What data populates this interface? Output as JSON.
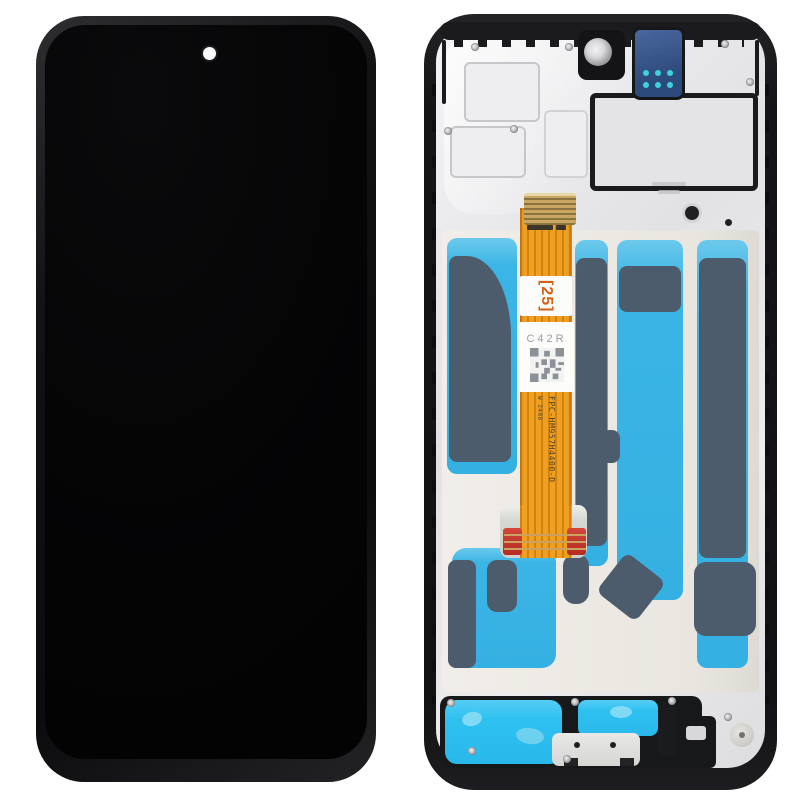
{
  "markings": {
    "flex_box_label": "[25]",
    "flex_label_code": "C42R",
    "flex_part_number": "FPC-HM957H4400-D",
    "flex_batch_code": "W 2408"
  },
  "colors": {
    "background": "#ffffff",
    "screen_black": "#050506",
    "frame_black": "#1b1b1d",
    "plate_silver": "#e8e8ea",
    "liner_beige": "#eeebe5",
    "adhesive_cyan": "#3ab5e5",
    "adhesive_cyan_bright": "#2ec1f0",
    "pad_slate": "#4d5c6c",
    "flex_orange": "#ef9f22",
    "connector_gold": "#c2a061",
    "camera_connector_blue": "#3d5c90",
    "connector_dot_teal": "#3bd2de",
    "sticker_red": "#c13129",
    "marking_orange": "#d4611a",
    "label_text_gray": "#979da4"
  }
}
